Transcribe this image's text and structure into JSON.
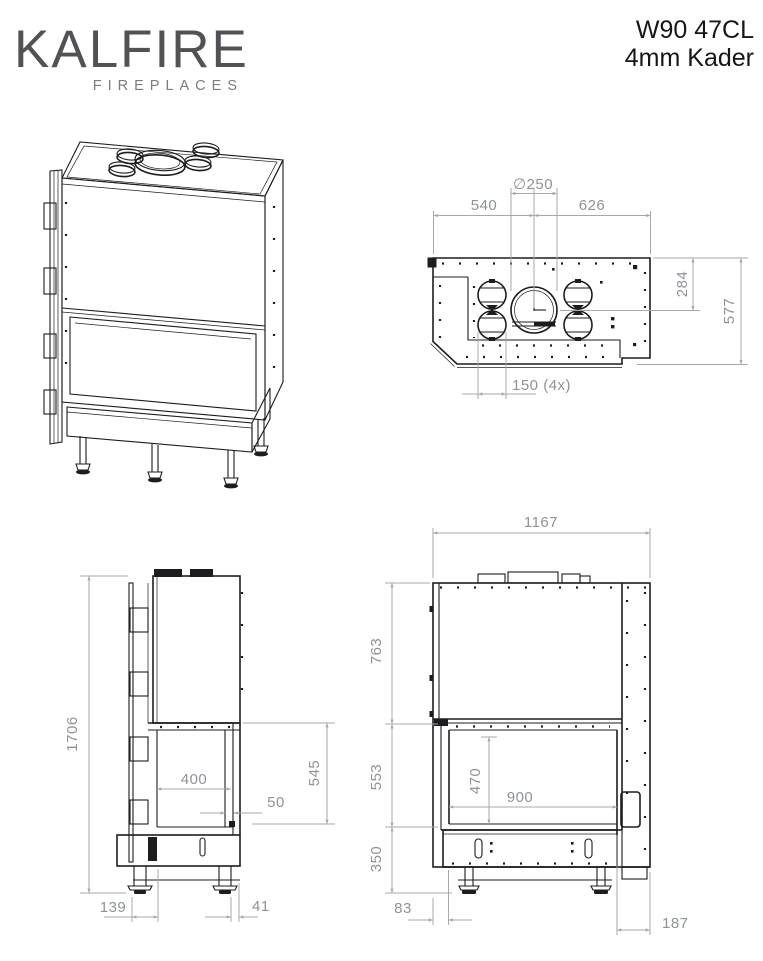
{
  "header": {
    "logo_primary": "KALFIRE",
    "logo_secondary": "FIREPLACES",
    "model": "W90 47CL",
    "variant": "4mm Kader"
  },
  "views": {
    "top": {
      "dims": {
        "flue_diameter": "∅250",
        "flue_from_left": "540",
        "flue_from_right": "626",
        "flue_from_back": "284",
        "depth": "577",
        "connector_diameter": "150 (4x)"
      }
    },
    "side": {
      "dims": {
        "total_height": "1706",
        "opening_depth": "400",
        "glass_offset": "50",
        "opening_section": "545",
        "front_offset": "139",
        "back_offset": "41"
      }
    },
    "front": {
      "dims": {
        "total_width": "1167",
        "top_section": "763",
        "window_section": "553",
        "base_section": "350",
        "opening_height": "470",
        "opening_width": "900",
        "left_offset": "83",
        "right_offset": "187"
      }
    }
  }
}
